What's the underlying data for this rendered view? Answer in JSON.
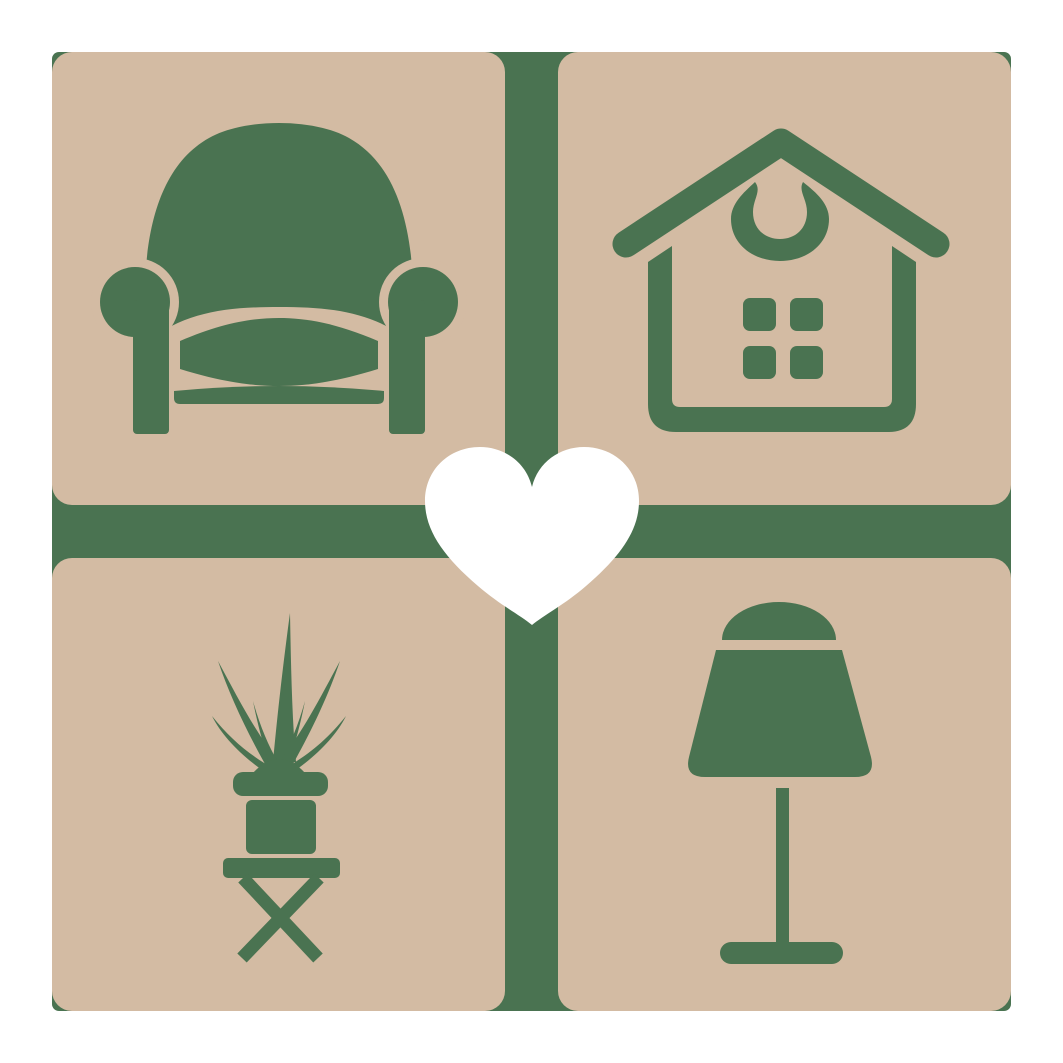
{
  "page": {
    "width_px": 1063,
    "height_px": 1063,
    "background": "#ffffff"
  },
  "logo": {
    "kind": "furniture-home-decor-logo",
    "grid": {
      "rows": 2,
      "cols": 2,
      "tile_size_px": 453,
      "gap_px": 53,
      "margin_px": 52,
      "tile_corner_radius_px": 20,
      "backdrop_corner_radius_px": 7
    },
    "tiles": [
      {
        "position": "top-left",
        "icon": "armchair"
      },
      {
        "position": "top-right",
        "icon": "house"
      },
      {
        "position": "bottom-left",
        "icon": "potted-plant-on-stool"
      },
      {
        "position": "bottom-right",
        "icon": "table-lamp"
      }
    ],
    "center_icon": "heart"
  },
  "colors": {
    "icon_green": "#4a7351",
    "tile_tan": "#d3bba3",
    "heart_white": "#ffffff",
    "page_background": "#ffffff"
  }
}
